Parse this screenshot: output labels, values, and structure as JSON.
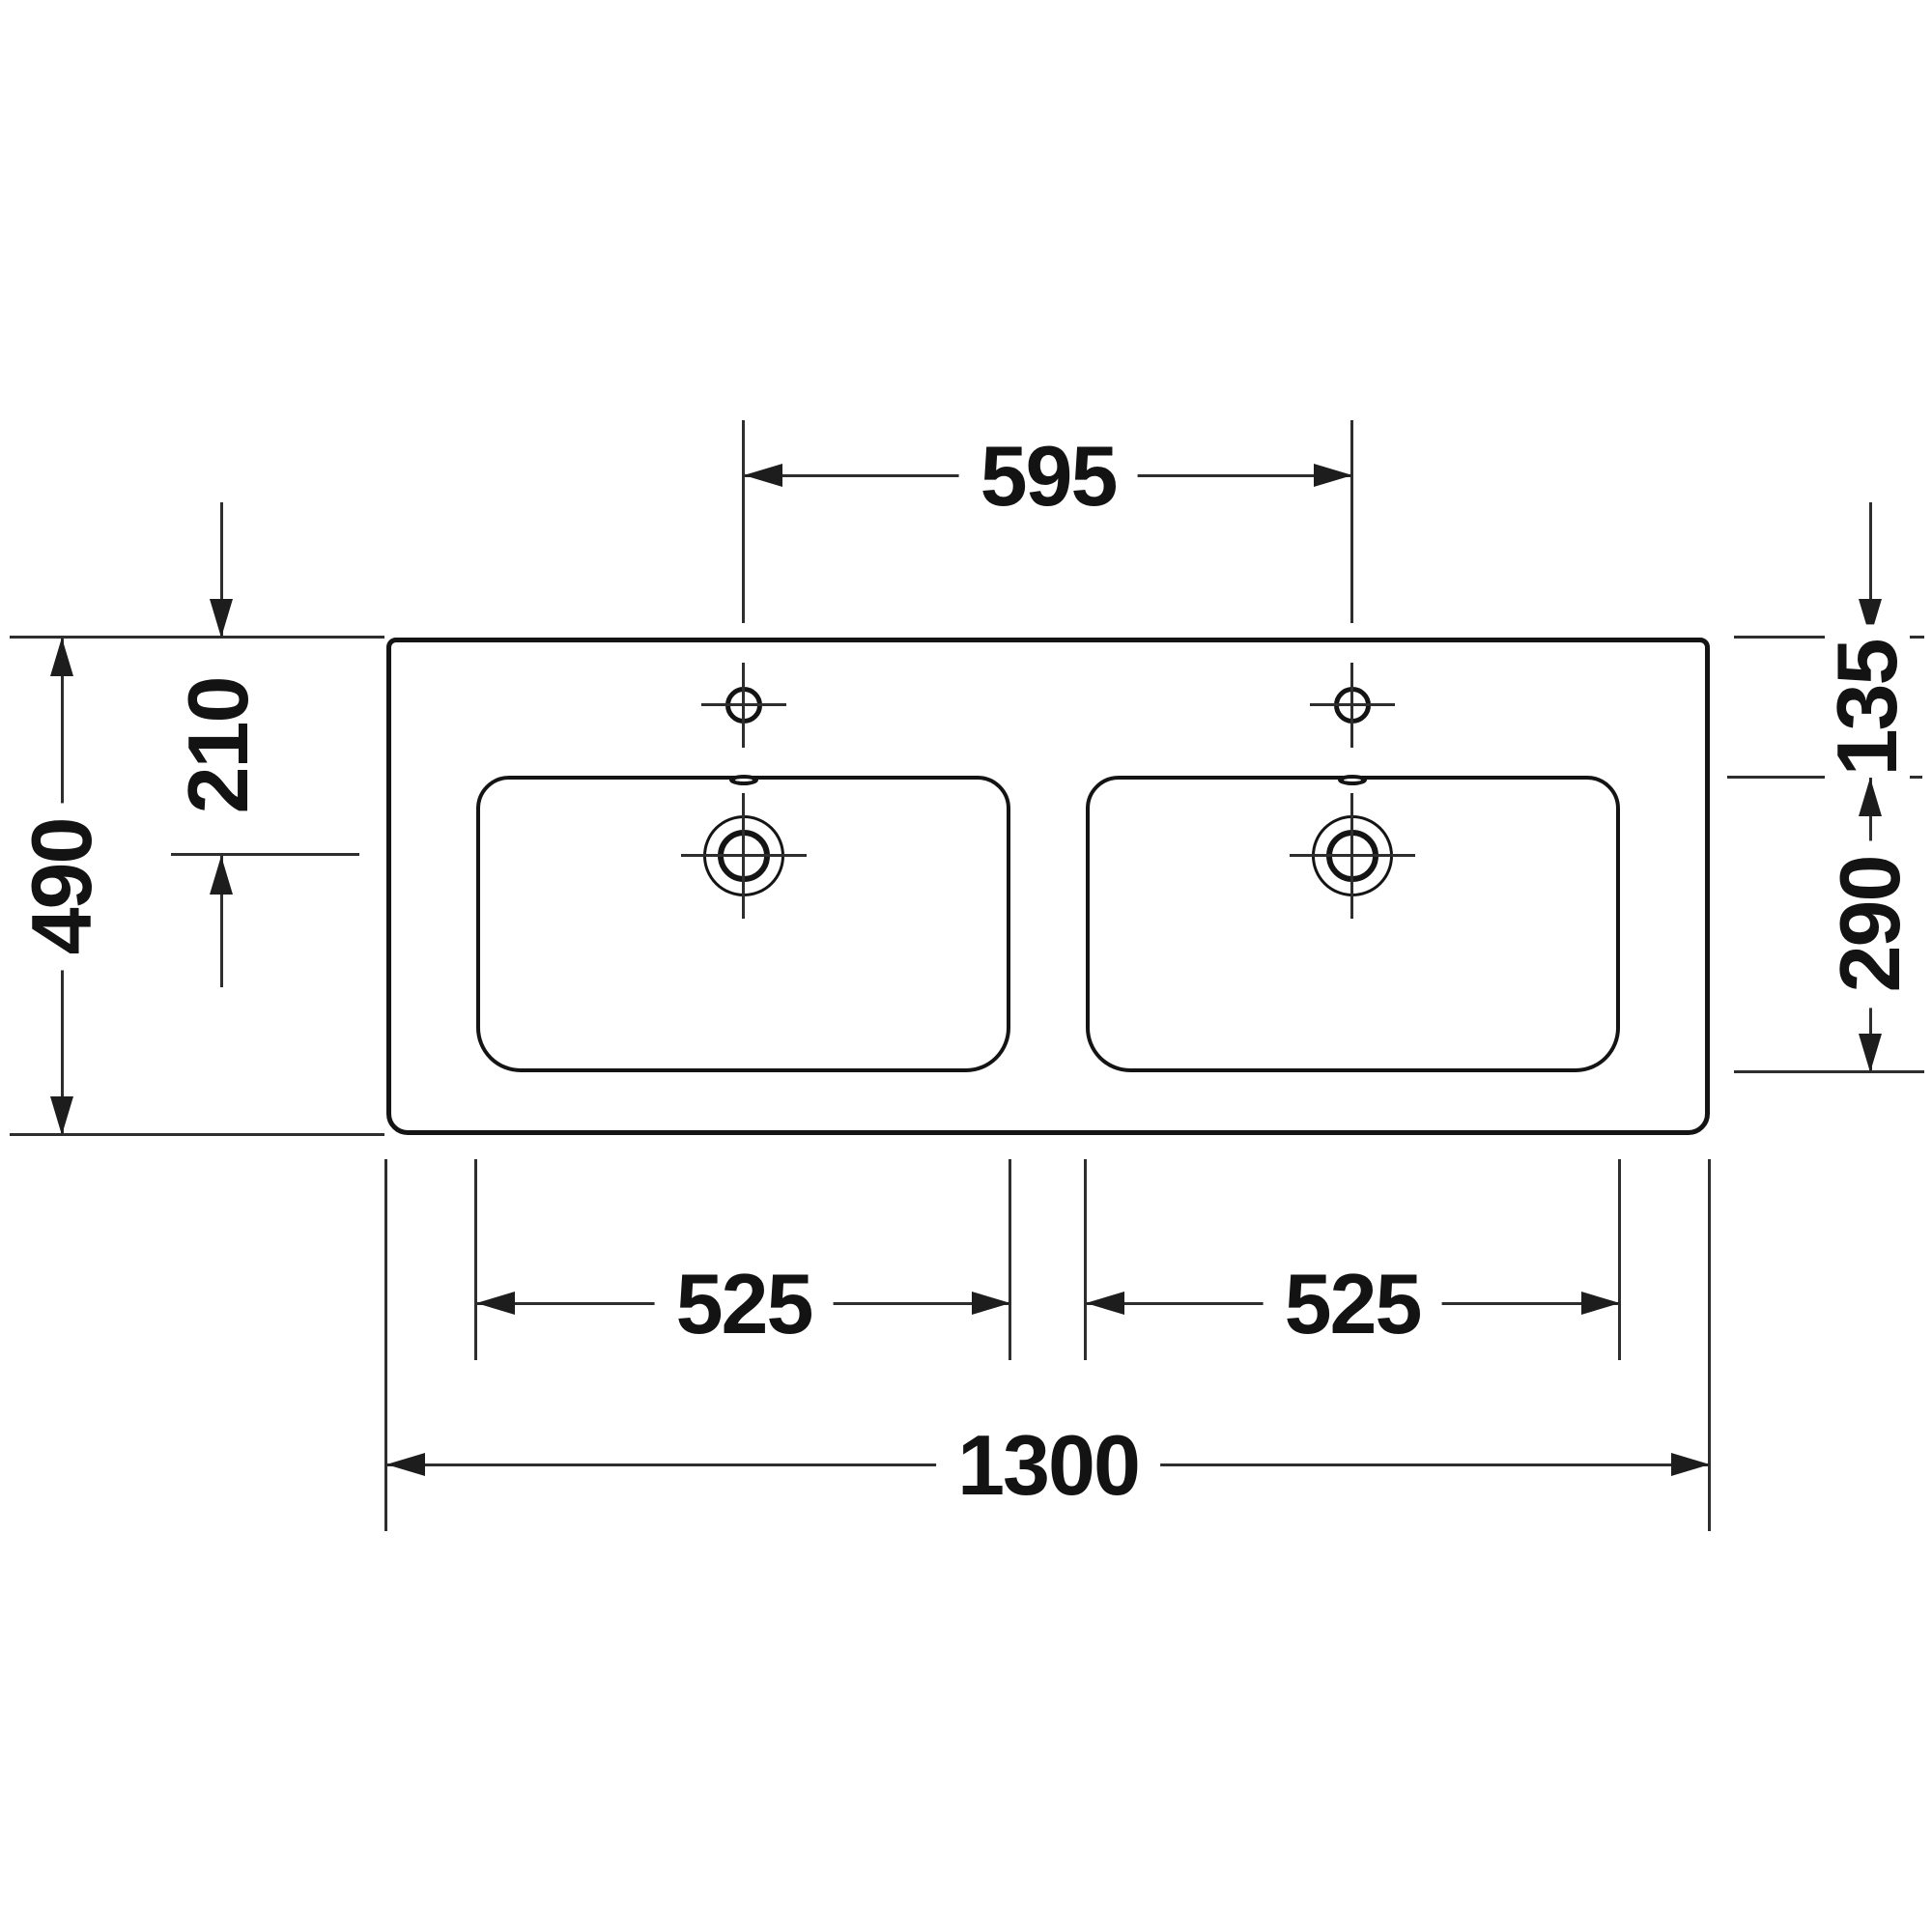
{
  "drawing": {
    "subject": "double-washbasin-technical-drawing-top-view",
    "colors": {
      "ink": "#141414",
      "dimension_line": "#2e2e2e",
      "background": "#ffffff"
    }
  },
  "dims": {
    "faucet_hole_spacing": "595",
    "overall_depth": "490",
    "front_to_drain_center": "210",
    "front_edge_to_basin": "135",
    "basin_front_to_back": "290",
    "basin_width_left": "525",
    "basin_width_right": "525",
    "overall_width": "1300"
  }
}
